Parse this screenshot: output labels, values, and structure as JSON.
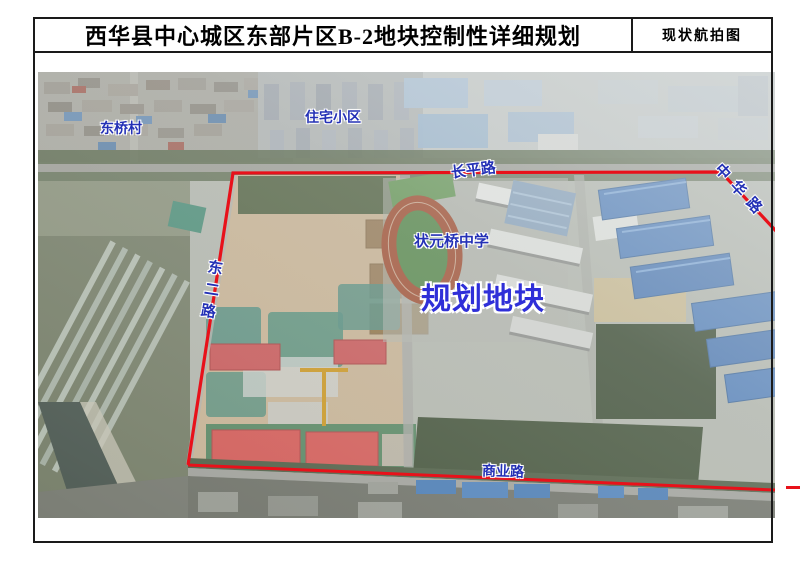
{
  "header": {
    "title": "西华县中心城区东部片区B-2地块控制性详细规划",
    "corner_label": "现状航拍图"
  },
  "map": {
    "type": "aerial-photo",
    "labels": {
      "village": "东桥村",
      "residential_area": "住宅小区",
      "road_north": "长平路",
      "road_east": "中华路",
      "school": "状元桥中学",
      "plot": "规划地块",
      "road_west": "东二路",
      "road_south": "商业路"
    }
  },
  "colors": {
    "boundary-red": "#e8111a",
    "label-blue": "#2431b6",
    "plot-label-blue": "#2f2fd8",
    "border-black": "#1a1a1a"
  }
}
